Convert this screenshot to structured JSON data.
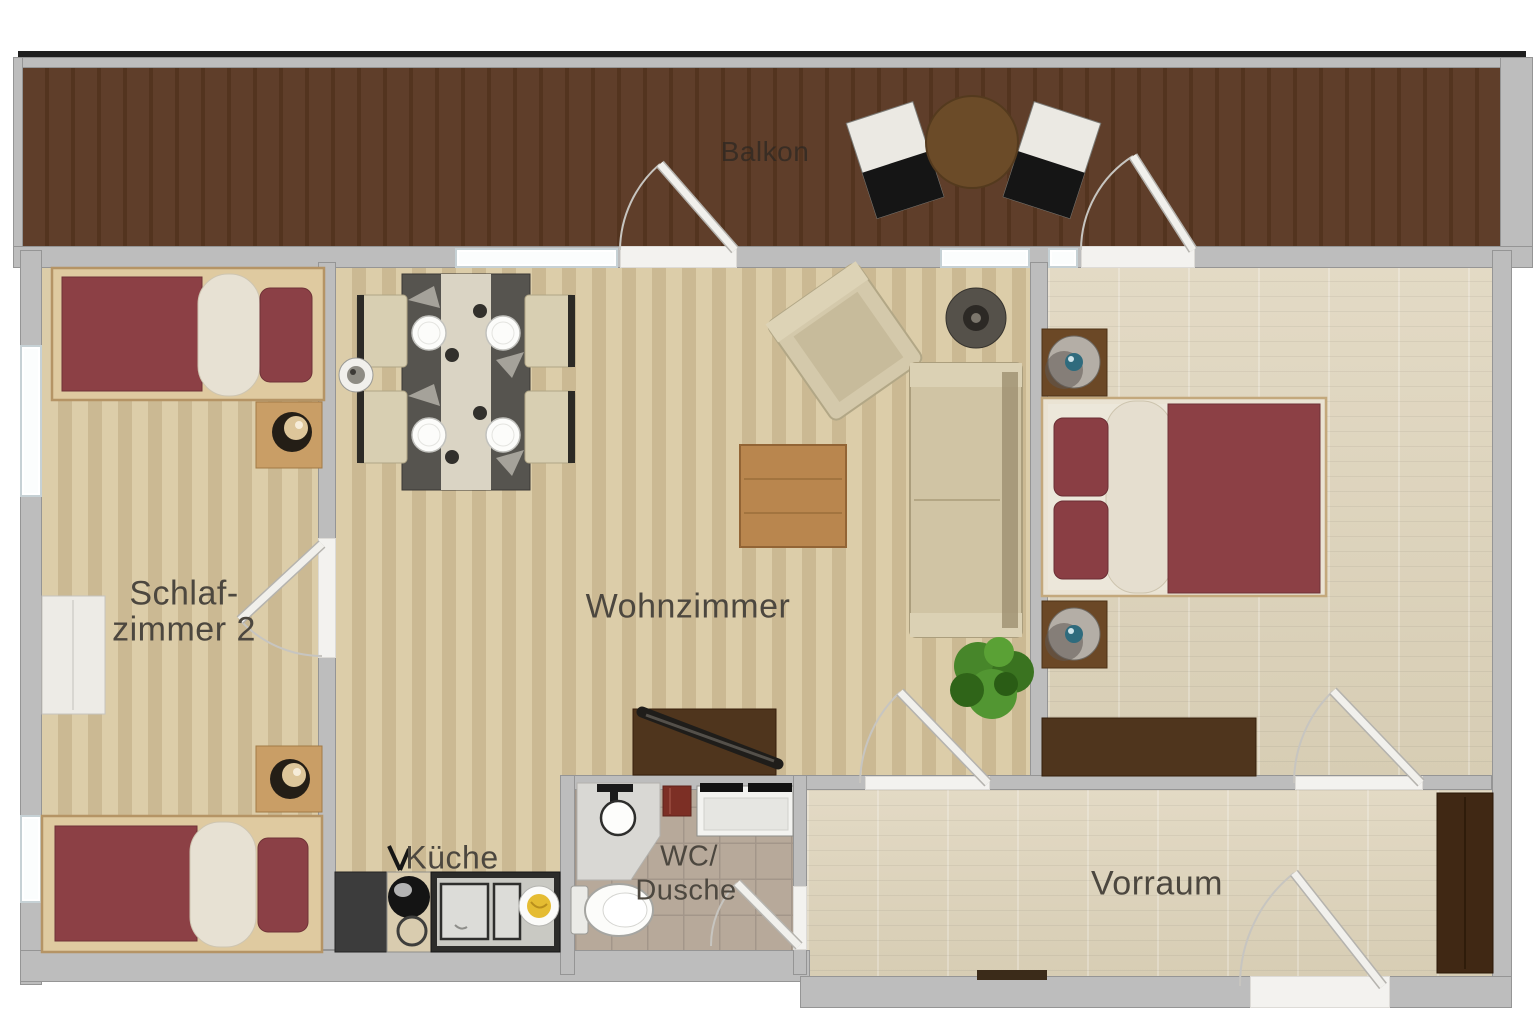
{
  "title": "Apartment floor plan",
  "rooms": {
    "balcony": {
      "label": "Balkon"
    },
    "bedroom2": {
      "line1": "Schlaf-",
      "line2": "zimmer 2"
    },
    "living": {
      "label": "Wohnzimmer"
    },
    "kitchen": {
      "label": "Küche"
    },
    "bath": {
      "line1": "WC/",
      "line2": "Dusche"
    },
    "hall": {
      "label": "Vorraum"
    }
  },
  "colors": {
    "wall": "#bdbdbd",
    "balcony_wood": "#5f3e2a",
    "balcony_wood_dark": "#53341f",
    "floor_light": "#d6c7a2",
    "floor_light_stripe": "#cbb993",
    "floor_parquet": "#e3dac5",
    "floor_parquet_dark": "#d7cdb4",
    "tile": "#b7a99a",
    "bed_red": "#8c4045",
    "sofa_beige": "#d0c4a4",
    "dark_wood": "#4f351d",
    "door_white": "#f1f0ec"
  }
}
